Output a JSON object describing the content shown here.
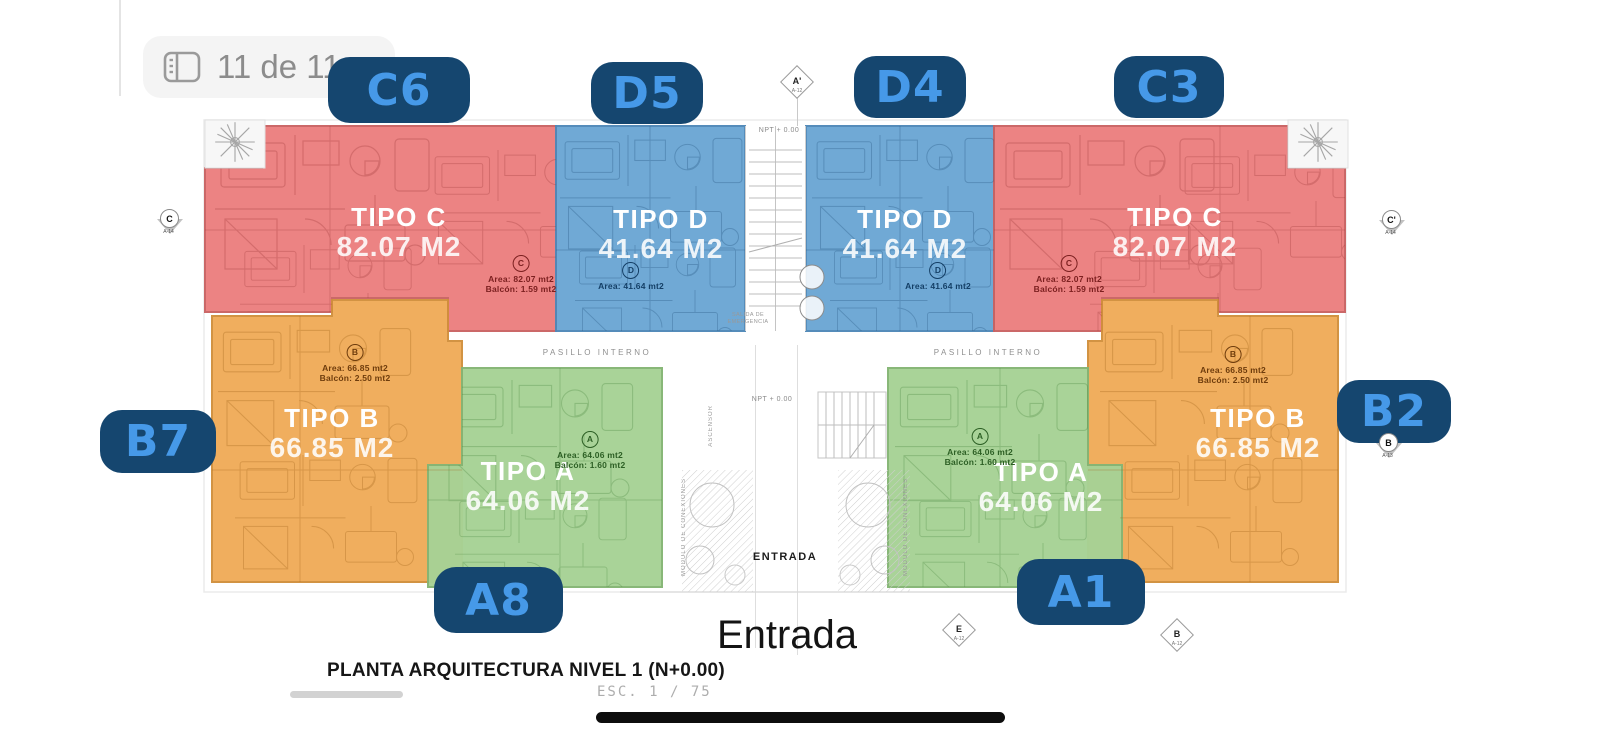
{
  "viewer": {
    "page_indicator": "11 de 11"
  },
  "colors": {
    "unit_red": "#ec7e7e",
    "unit_blue": "#6ba6d4",
    "unit_orange": "#f0ab58",
    "unit_green": "#a7d295",
    "badge_bg": "#15466f",
    "badge_text": "#4699e8"
  },
  "units": [
    {
      "badge": "C6",
      "tipo": "TIPO C",
      "area": "82.07 M2",
      "circle": "C",
      "detail_area": "Area: 82.07 mt2",
      "detail_balcony": "Balcón: 1.59 mt2"
    },
    {
      "badge": "D5",
      "tipo": "TIPO D",
      "area": "41.64 M2",
      "circle": "D",
      "detail_area": "Area: 41.64 mt2"
    },
    {
      "badge": "D4",
      "tipo": "TIPO D",
      "area": "41.64 M2",
      "circle": "D",
      "detail_area": "Area: 41.64 mt2"
    },
    {
      "badge": "C3",
      "tipo": "TIPO C",
      "area": "82.07 M2",
      "circle": "C",
      "detail_area": "Area: 82.07 mt2",
      "detail_balcony": "Balcón: 1.59 mt2"
    },
    {
      "badge": "B7",
      "tipo": "TIPO B",
      "area": "66.85 M2",
      "circle": "B",
      "detail_area": "Area: 66.85 mt2",
      "detail_balcony": "Balcón: 2.50 mt2"
    },
    {
      "badge": "A8",
      "tipo": "TIPO A",
      "area": "64.06 M2",
      "circle": "A",
      "detail_area": "Area: 64.06 mt2",
      "detail_balcony": "Balcón: 1.60 mt2"
    },
    {
      "badge": "A1",
      "tipo": "TIPO A",
      "area": "64.06 M2",
      "circle": "A",
      "detail_area": "Area: 64.06 mt2",
      "detail_balcony": "Balcón: 1.60 mt2"
    },
    {
      "badge": "B2",
      "tipo": "TIPO B",
      "area": "66.85 M2",
      "circle": "B",
      "detail_area": "Area: 66.85 mt2",
      "detail_balcony": "Balcón: 2.50 mt2"
    }
  ],
  "plan_labels": {
    "pasillo_interno": "PASILLO INTERNO",
    "entrada_small": "ENTRADA",
    "npt": "NPT + 0.00",
    "salida_emergencia": "SALIDA DE EMERGENCIA",
    "ascensor": "ASCENSOR",
    "modulo_conexiones": "MODULO DE CONEXIONES"
  },
  "markers": [
    {
      "letter": "A'",
      "code": "A-12"
    },
    {
      "letter": "C",
      "code": "A-14"
    },
    {
      "letter": "C'",
      "code": "A-14"
    },
    {
      "letter": "B",
      "code": "A-13"
    },
    {
      "letter": "E",
      "code": "A-12"
    },
    {
      "letter": "B",
      "code": "A-12"
    }
  ],
  "entrance_label": "Entrada",
  "title_block": {
    "title": "PLANTA ARQUITECTURA NIVEL 1 (N+0.00)",
    "scale": "ESC. 1 / 75"
  }
}
